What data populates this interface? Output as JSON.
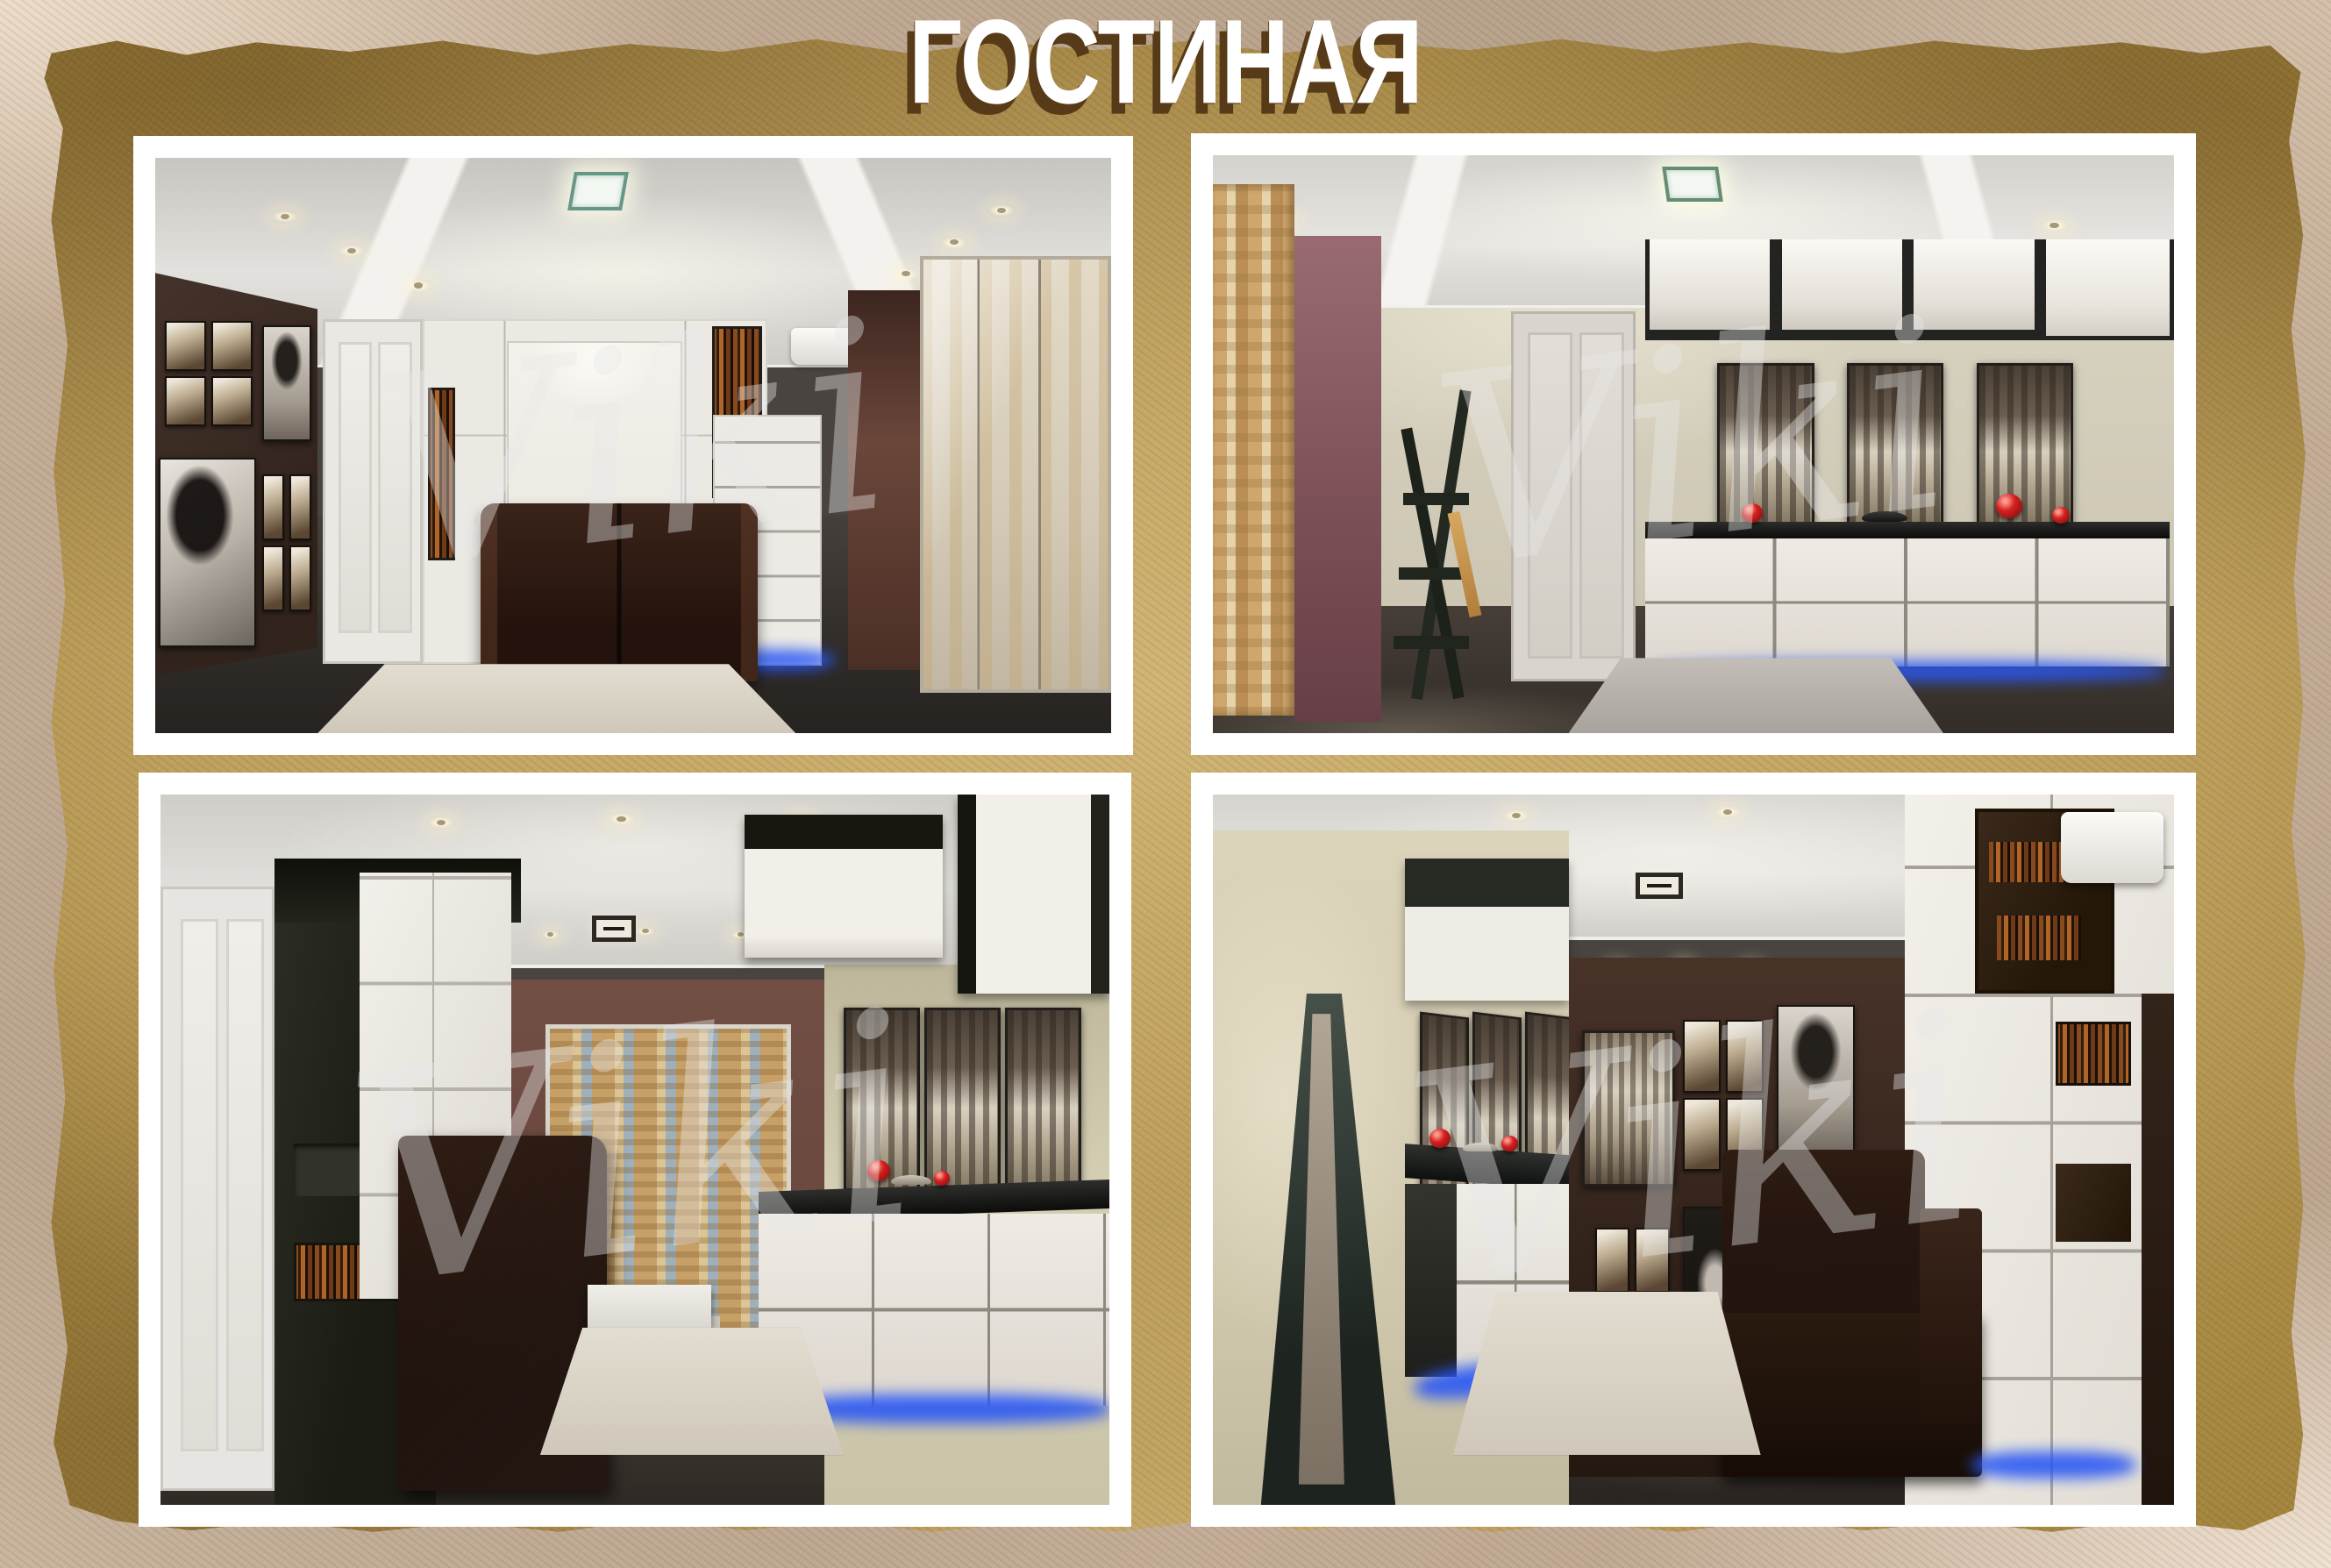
{
  "poster": {
    "title": "ГОСТИНАЯ",
    "watermark": "Viki",
    "colors": {
      "parchment": "#a08441",
      "outer_border_tan": "#c2ab95",
      "title_white": "#ffffff",
      "title_shadow": "#573a17",
      "panel_frame": "#ffffff",
      "led_blue": "#2a58f5",
      "decor_red": "#d42020",
      "dark_wood": "#2b1a12",
      "cabinet_white": "#ece9e3"
    },
    "panels": [
      {
        "id": "top-left",
        "description": "Render 1: living room with dark brown photo gallery wall, white door, white wall-bed cabinet unit with book shelves, brown sofa, shaggy rug and curtained window"
      },
      {
        "id": "top-right",
        "description": "Render 2: living room with patterned curtain, mauve wall, black ladder shelf, white door, floating cabinets, three city canvases, long sideboard with red decor and blue backlight"
      },
      {
        "id": "bottom-left",
        "description": "Render 3: living room with white door, dark bookcase tower, brown sofa, curtained window, beige wall with city canvases and backlit sideboard"
      },
      {
        "id": "bottom-right",
        "description": "Render 4: living room with leaning floor mirror, backlit chest with red decor, dark photo gallery wall, white wardrobe wall with books, air conditioner and brown sofa"
      }
    ]
  }
}
